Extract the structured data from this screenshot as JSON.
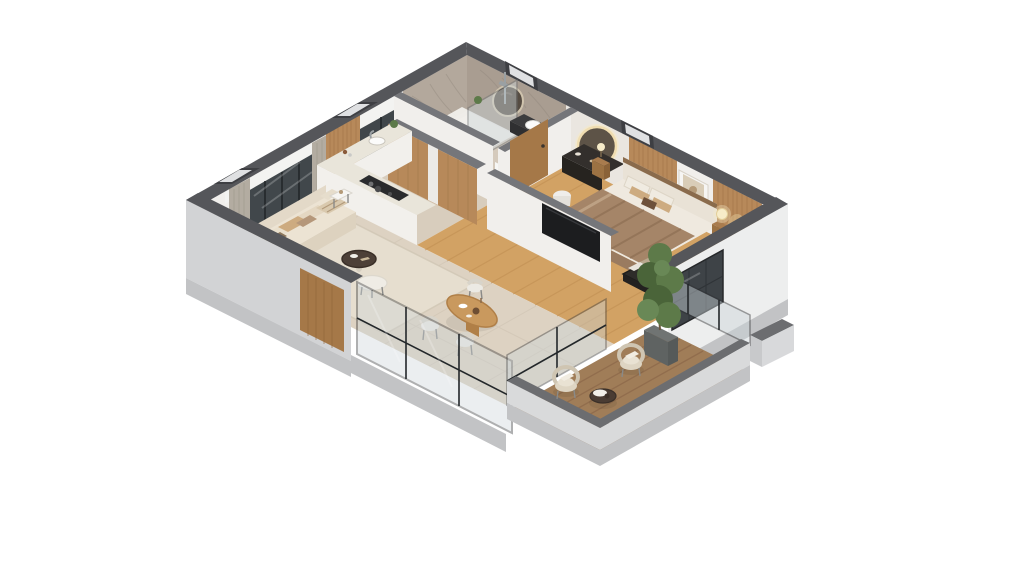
{
  "scene": {
    "title": "3D isometric cutaway floor plan of a one-bedroom apartment",
    "view": "dollhouse isometric from the south, white background",
    "background": "#ffffff"
  },
  "colors": {
    "wall_top": "#55565a",
    "wall_top_light": "#75767a",
    "wall_outer": "#d2d3d5",
    "wall_outer_white": "#edeeee",
    "slab": "#c2c3c5",
    "inner_wall": "#f1efec",
    "marble_nw": "#b3a89c",
    "marble_ne": "#a99d91",
    "wood_slat": "#b7895a",
    "wood_floor": "#d2a264",
    "tile_floor": "#ddd2c2",
    "bath_floor": "#d5cabc",
    "kitchen_floor": "#d8cdbd",
    "deck": "#a07d58",
    "rug": "#e6decf",
    "glass": "#ccd5d9",
    "frame_dark": "#2e2f31",
    "counter": "#e9e5da",
    "counter_face": "#f2f0ec",
    "cooktop": "#2a2b2d",
    "sofa": "#ece3d3",
    "sofa_back": "#e3d9c8",
    "cushion_tan": "#cdab80",
    "blanket": "#a58568",
    "mattress": "#efe9df",
    "headboard": "#e9e2d6",
    "dark_wood": "#a97c4e",
    "vanity_dark": "#332f2c",
    "tv": "#1c1d1f",
    "plant": "#5d7a49",
    "plant_dark": "#4a6439",
    "lamp_glow": "#f7ecc9",
    "curtain": "#b3aca1",
    "parapet_top": "#6c6d70",
    "parapet_face": "#d9dadb",
    "wood_door": "#a57848",
    "dining_table": "#c9995e",
    "chair_light": "#eceae4",
    "wicker": "#ded5c3",
    "balcony_table": "#4a3c33",
    "white_trim": "#f3f3f1"
  },
  "rooms": [
    {
      "id": "living-room",
      "objects": [
        "window-wall-with-curtains",
        "sofa-with-cushions",
        "floor-lamp-glowing",
        "side-tables",
        "coffee-table",
        "ottoman",
        "woven-bench",
        "area-rug"
      ]
    },
    {
      "id": "dining-area",
      "objects": [
        "oval-wood-table",
        "dining-chairs",
        "table-decor"
      ]
    },
    {
      "id": "kitchen",
      "objects": [
        "l-shaped-counter",
        "cooktop",
        "sink",
        "wood-slat-backsplash",
        "kitchen-window"
      ]
    },
    {
      "id": "bathroom",
      "objects": [
        "marble-walls",
        "walk-in-shower-glass",
        "toilet",
        "vessel-basin",
        "round-mirror"
      ]
    },
    {
      "id": "vanity-nook",
      "objects": [
        "backlit-round-mirror",
        "dark-vanity-desk",
        "white-stool",
        "wood-cabinet",
        "interior-door"
      ]
    },
    {
      "id": "bedroom",
      "objects": [
        "double-bed",
        "striped-blanket",
        "pillows",
        "wood-slat-accent-wall",
        "framed-art",
        "nightstands",
        "glowing-lamp",
        "storage-bench",
        "tv-partition",
        "wood-floor"
      ]
    },
    {
      "id": "balcony",
      "objects": [
        "wood-deck",
        "two-wicker-chairs",
        "round-coffee-table",
        "tall-potted-plant",
        "glass-balustrade",
        "parapet-walls"
      ]
    }
  ]
}
